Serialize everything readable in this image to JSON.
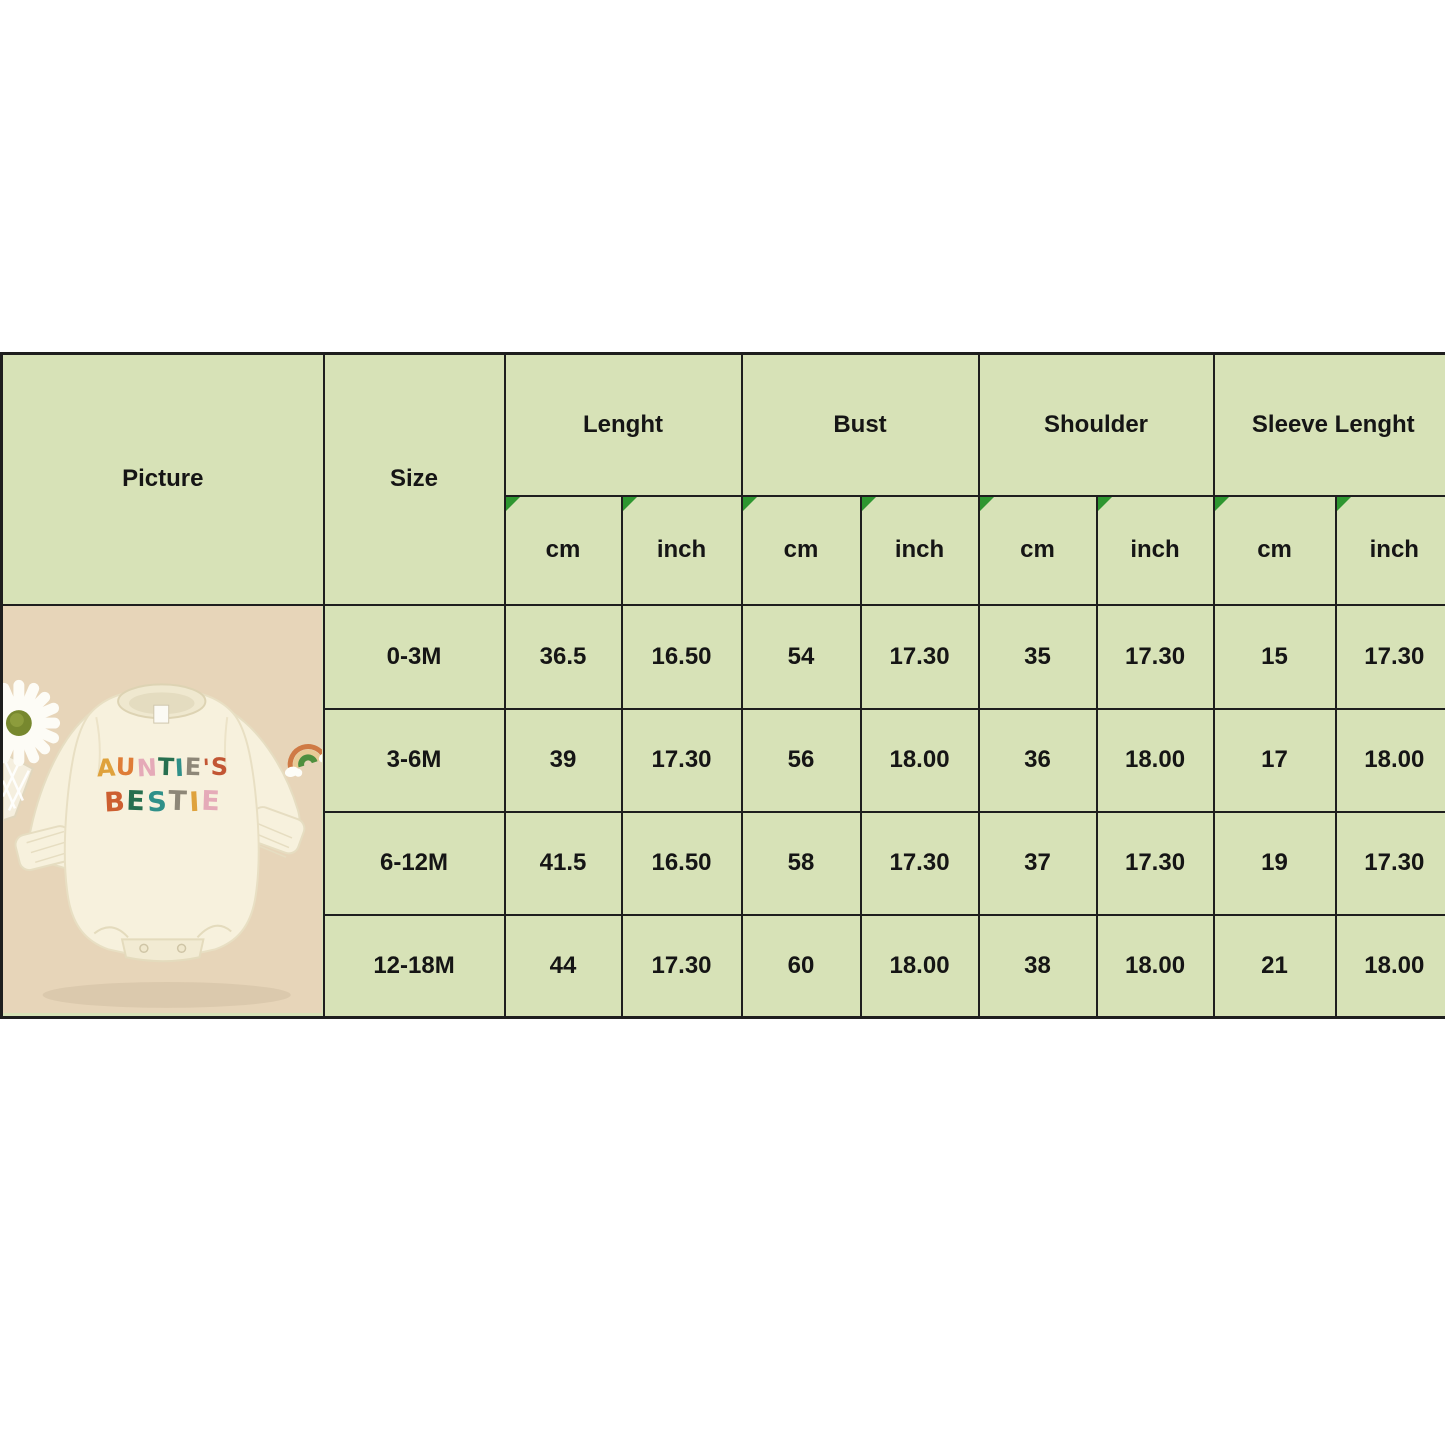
{
  "colors": {
    "table_border": "#1e1e1e",
    "header_fill": "#d7e2b7",
    "row_light_fill": "#eef1dd",
    "row_dark_fill": "#d5e1b2",
    "marker_green": "#2e9630",
    "picture_bg": "#e7d5b9",
    "romper_cream": "#f7f1dd",
    "text_color": "#151515"
  },
  "icons": {
    "corner_marker": "green-corner-triangle",
    "daisy": "white-daisy-flower",
    "rainbow": "rainbow-with-clouds"
  },
  "size_chart": {
    "picture_header": "Picture",
    "size_header": "Size",
    "measure_groups": [
      {
        "label": "Lenght",
        "units": [
          "cm",
          "inch"
        ]
      },
      {
        "label": "Bust",
        "units": [
          "cm",
          "inch"
        ]
      },
      {
        "label": "Shoulder",
        "units": [
          "cm",
          "inch"
        ]
      },
      {
        "label": "Sleeve Lenght",
        "units": [
          "cm",
          "inch"
        ]
      }
    ],
    "rows": [
      {
        "size": "0-3M",
        "values": [
          "36.5",
          "16.50",
          "54",
          "17.30",
          "35",
          "17.30",
          "15",
          "17.30"
        ]
      },
      {
        "size": "3-6M",
        "values": [
          "39",
          "17.30",
          "56",
          "18.00",
          "36",
          "18.00",
          "17",
          "18.00"
        ]
      },
      {
        "size": "6-12M",
        "values": [
          "41.5",
          "16.50",
          "58",
          "17.30",
          "37",
          "17.30",
          "19",
          "17.30"
        ]
      },
      {
        "size": "12-18M",
        "values": [
          "44",
          "17.30",
          "60",
          "18.00",
          "38",
          "18.00",
          "21",
          "18.00"
        ]
      }
    ]
  },
  "chart_data": {
    "type": "table",
    "title": "Baby romper size chart",
    "columns": [
      "Size",
      "Lenght cm",
      "Lenght inch",
      "Bust cm",
      "Bust inch",
      "Shoulder cm",
      "Shoulder inch",
      "Sleeve Lenght cm",
      "Sleeve Lenght inch"
    ],
    "rows": [
      [
        "0-3M",
        "36.5",
        "16.50",
        "54",
        "17.30",
        "35",
        "17.30",
        "15",
        "17.30"
      ],
      [
        "3-6M",
        "39",
        "17.30",
        "56",
        "18.00",
        "36",
        "18.00",
        "17",
        "18.00"
      ],
      [
        "6-12M",
        "41.5",
        "16.50",
        "58",
        "17.30",
        "37",
        "17.30",
        "19",
        "17.30"
      ],
      [
        "12-18M",
        "44",
        "17.30",
        "60",
        "18.00",
        "38",
        "18.00",
        "21",
        "18.00"
      ]
    ]
  },
  "product_photo": {
    "line1": "AUNTIE'S",
    "line1_colors": [
      "#dfa23c",
      "#df7d37",
      "#e5aab8",
      "#276f4f",
      "#2f9089",
      "#8d8778",
      "#c25634",
      "#c25634"
    ],
    "line2": "BESTIE",
    "line2_colors": [
      "#cd5f30",
      "#276f4f",
      "#2f9089",
      "#8d8778",
      "#dfa23c",
      "#e5aab8"
    ]
  }
}
